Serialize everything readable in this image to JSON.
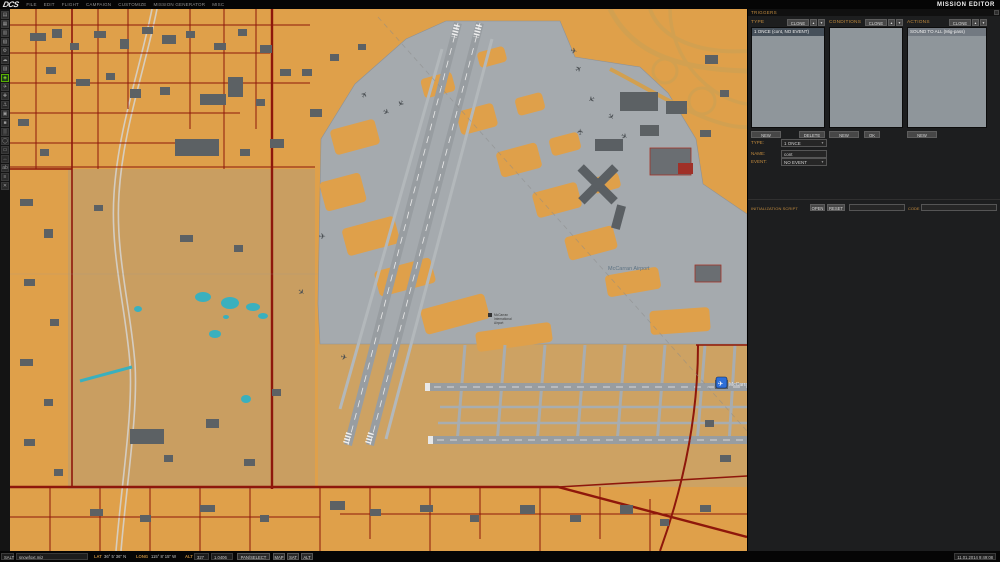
{
  "topbar": {
    "logo": "DCS",
    "menu": [
      "FILE",
      "EDIT",
      "FLIGHT",
      "CAMPAIGN",
      "CUSTOMIZE",
      "MISSION GENERATOR",
      "MISC"
    ],
    "title": "MISSION EDITOR"
  },
  "toolbar": {
    "icons": [
      {
        "name": "new-mission-icon",
        "glyph": "▤"
      },
      {
        "name": "open-mission-icon",
        "glyph": "▦"
      },
      {
        "name": "save-mission-icon",
        "glyph": "▥"
      },
      {
        "name": "briefing-icon",
        "glyph": "▧"
      },
      {
        "name": "mission-options-icon",
        "glyph": "⚙"
      },
      {
        "name": "weather-icon",
        "glyph": "☁"
      },
      {
        "name": "rules-icon",
        "glyph": "▨"
      },
      {
        "name": "triggers-icon",
        "glyph": "◈",
        "active": true
      },
      {
        "name": "airplane-group-icon",
        "glyph": "✈"
      },
      {
        "name": "helicopter-group-icon",
        "glyph": "✚"
      },
      {
        "name": "ship-group-icon",
        "glyph": "⚓"
      },
      {
        "name": "vehicle-group-icon",
        "glyph": "▣"
      },
      {
        "name": "static-object-icon",
        "glyph": "■"
      },
      {
        "name": "template-icon",
        "glyph": "▒"
      },
      {
        "name": "trigger-zone-icon",
        "glyph": "◯"
      },
      {
        "name": "map-layer-icon",
        "glyph": "▭"
      },
      {
        "name": "distance-tool-icon",
        "glyph": "↔"
      },
      {
        "name": "labels-icon",
        "glyph": "ab"
      },
      {
        "name": "ruler-icon",
        "glyph": "≡"
      },
      {
        "name": "exit-icon",
        "glyph": "✕"
      }
    ]
  },
  "triggers": {
    "header": "TRIGGERS",
    "clone_label": "CLONE",
    "up_glyph": "▲",
    "down_glyph": "▼",
    "columns": {
      "type": {
        "label": "TYPE",
        "item": "1 ONCE (cont, NO EVENT)",
        "new": "NEW",
        "delete": "DELETE"
      },
      "conditions": {
        "label": "CONDITIONS",
        "new": "NEW",
        "ok": "OK"
      },
      "actions": {
        "label": "ACTIONS",
        "item": "SOUND TO ALL (Mig-pass)",
        "new": "NEW"
      }
    },
    "fields": {
      "type_label": "TYPE:",
      "type_value": "1 ONCE",
      "name_label": "NAME:",
      "name_value": "cont",
      "event_label": "EVENT:",
      "event_value": "NO EVENT"
    },
    "script": {
      "label": "INITIALIZATION SCRIPT",
      "open": "OPEN",
      "reset": "RESET",
      "file_value": "",
      "code_label": "CODE",
      "code_value": ""
    }
  },
  "map": {
    "airport_label": "McCarran Airport",
    "marker_label": "McCarran Intl",
    "landmark_lines": [
      "McCarran",
      "International",
      "Airport"
    ],
    "colors": {
      "land": "#DFA04A",
      "desert": "#C99E61",
      "pavement": "#A5AAAE",
      "runway": "#989DA1",
      "buildings": "#5C6164",
      "roads": "#8E170B",
      "water": "#3AB0BE",
      "marker": "#2E6FD8"
    }
  },
  "statusbar": {
    "mode": "SALT",
    "filename": "snowfoxt.miz",
    "lat_label": "LAT",
    "lat_value": "36° 5' 36\" N",
    "long_label": "LONG",
    "long_value": "115° 8' 15\" W",
    "alt_label": "ALT",
    "alt_value": "327",
    "zoom_value": "1.0406",
    "pan_select": "PAN/SELECT",
    "map": "MAP",
    "sat": "SAT",
    "alt": "ALT",
    "datetime": "11.01.2014 9:49:08"
  }
}
